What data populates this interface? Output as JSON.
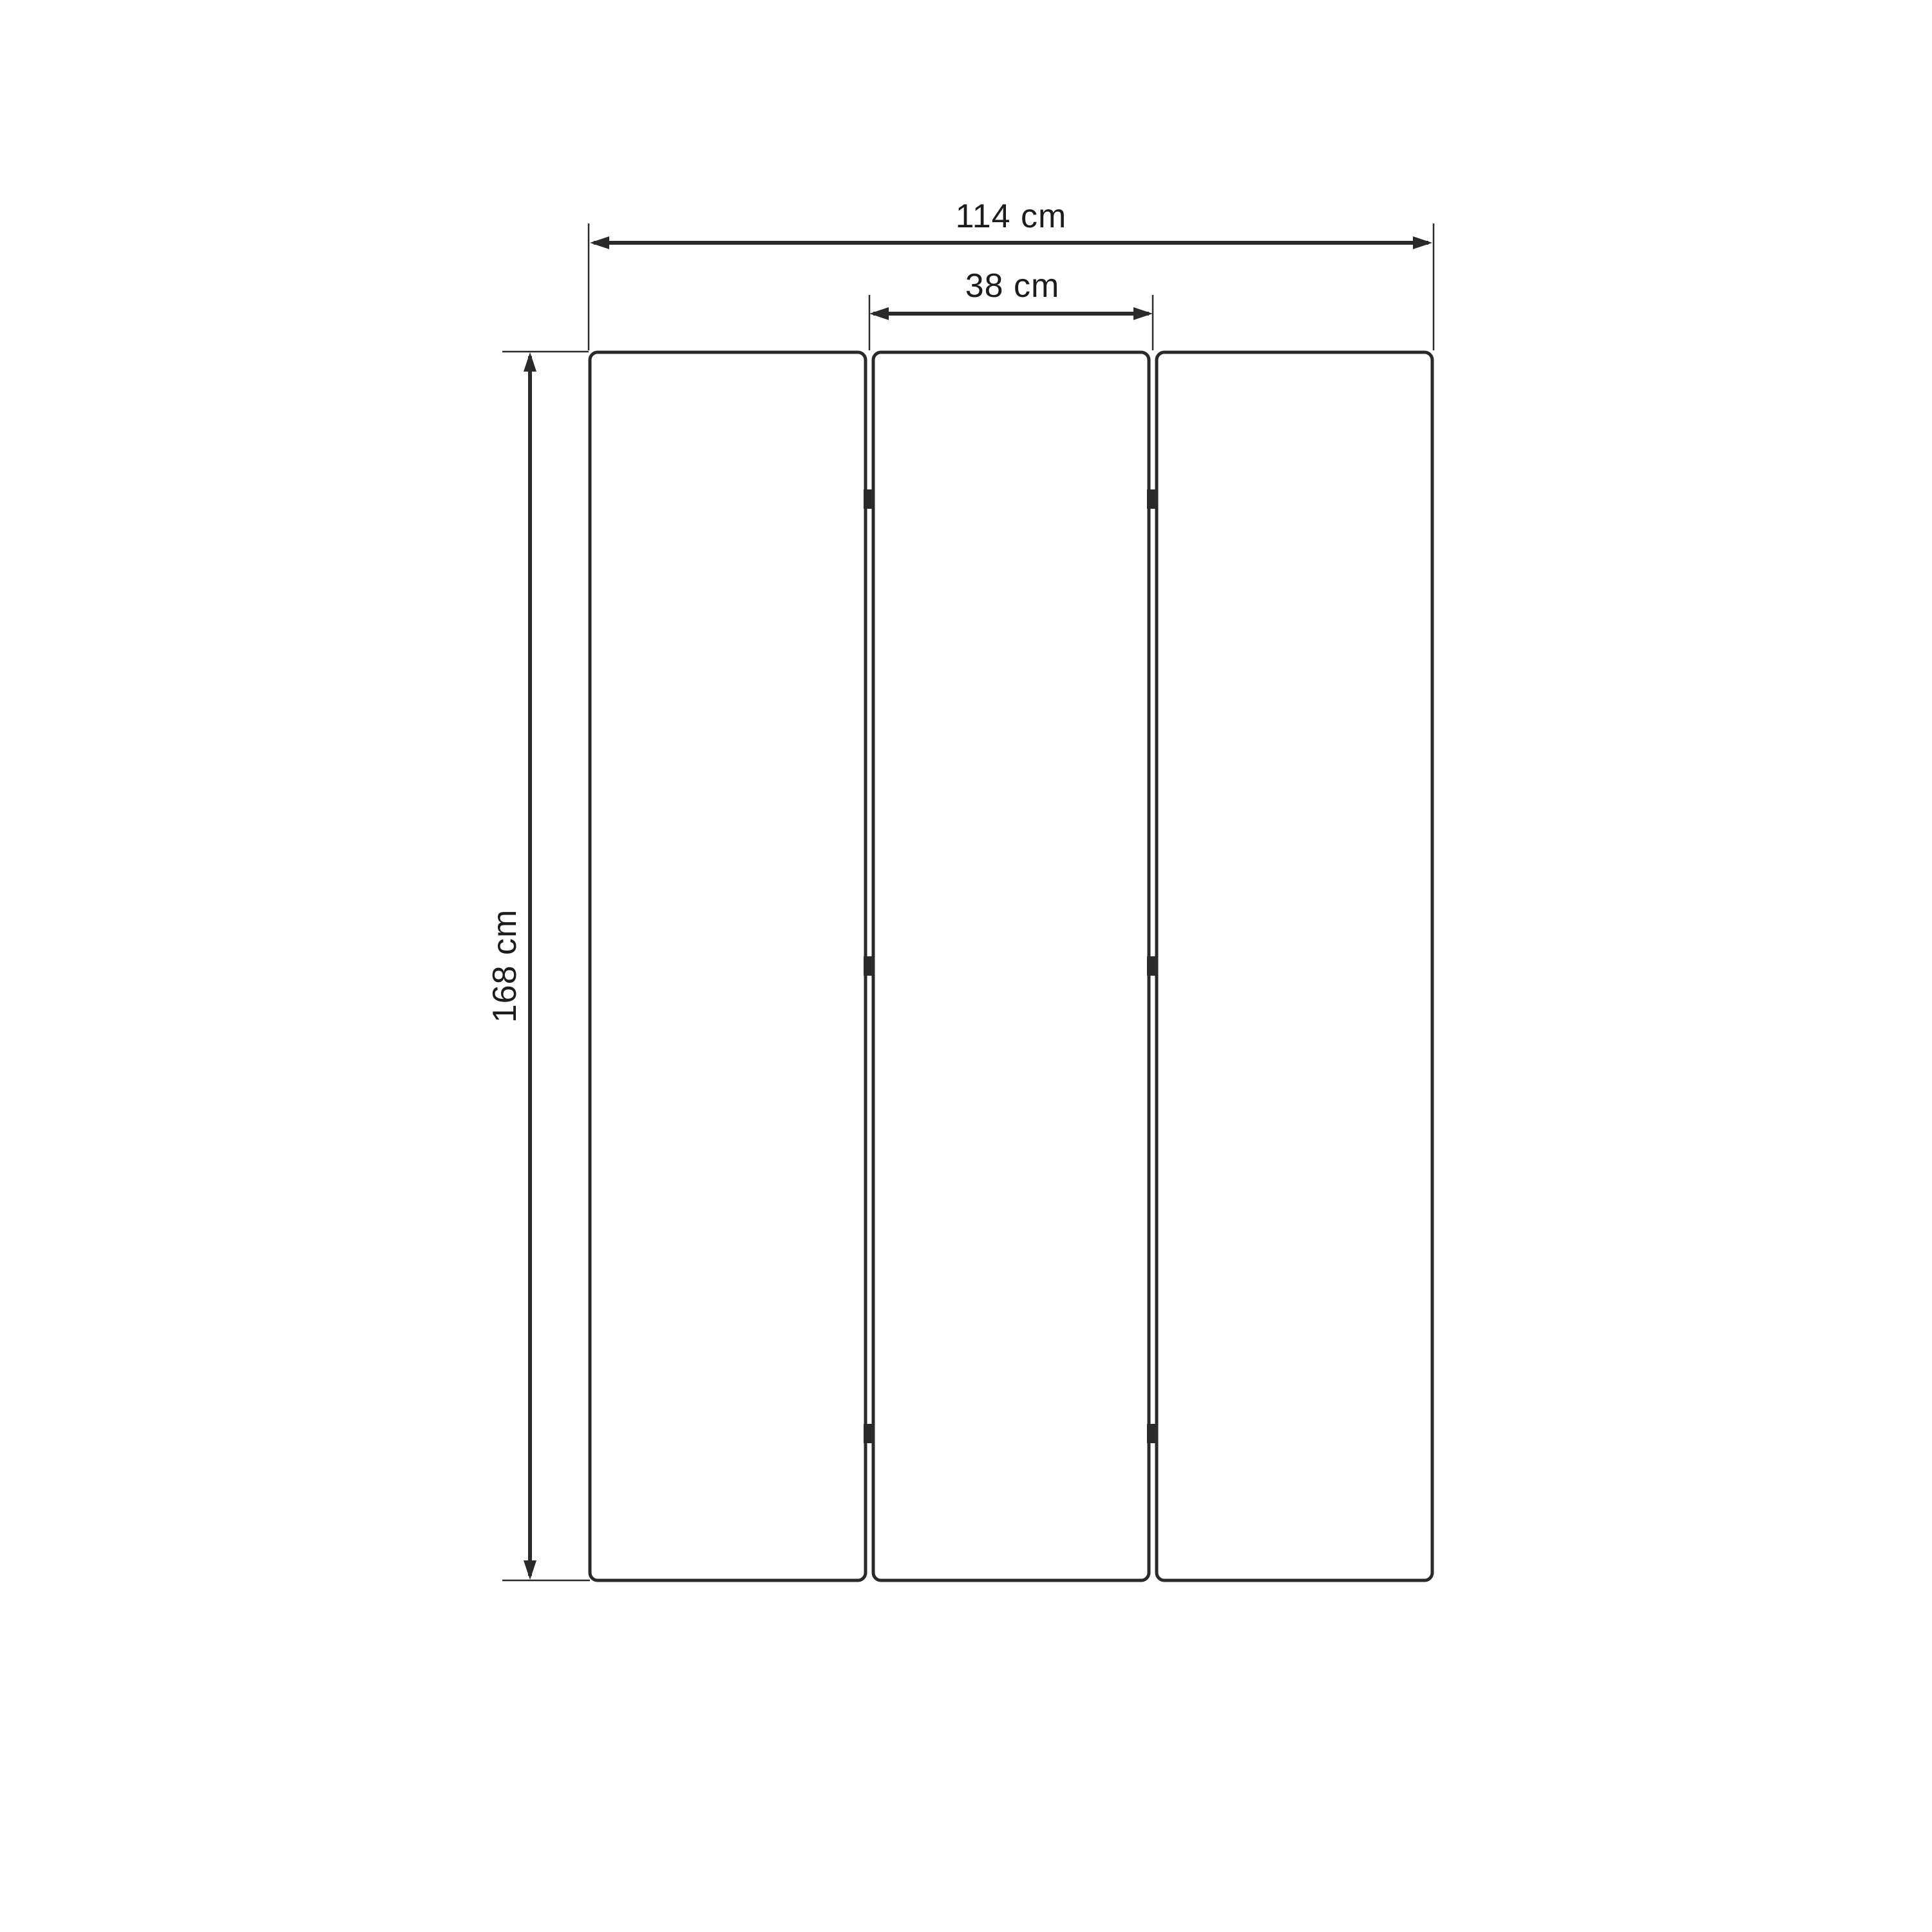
{
  "diagram": {
    "background_color": "#ffffff",
    "line_color": "#2a2a2a",
    "text_color": "#1c1c1c",
    "panels": {
      "count": 3,
      "gaps": 2,
      "hinge_rows": 3
    },
    "dimensions": {
      "total_width": {
        "label": "114 cm",
        "value": 114,
        "unit": "cm"
      },
      "panel_width": {
        "label": "38 cm",
        "value": 38,
        "unit": "cm"
      },
      "height": {
        "label": "168 cm",
        "value": 168,
        "unit": "cm"
      }
    }
  }
}
